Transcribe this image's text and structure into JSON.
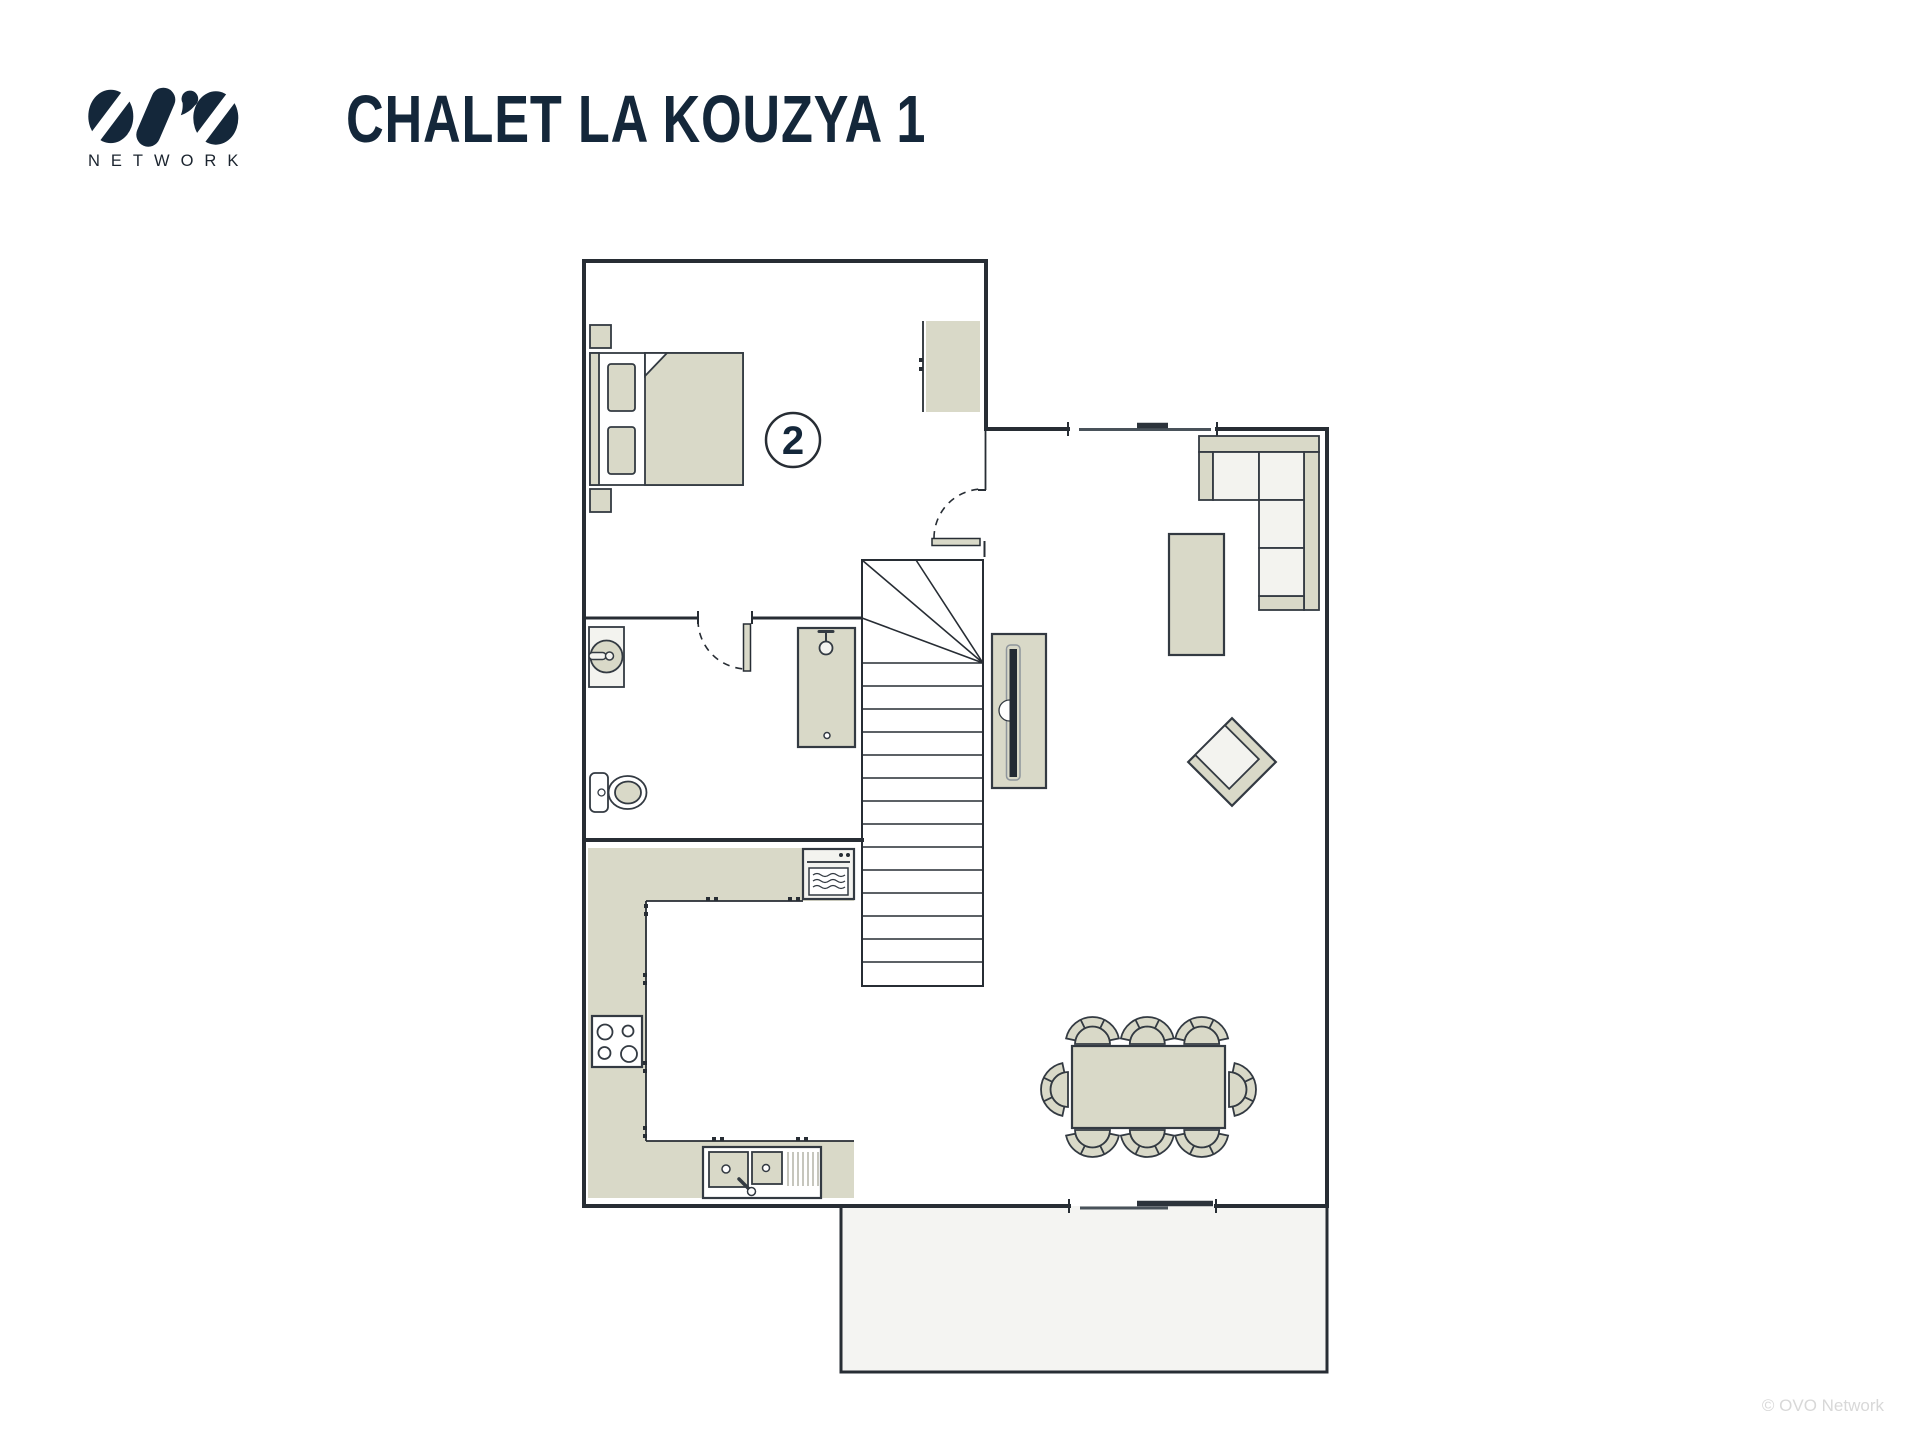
{
  "header": {
    "logo": {
      "icon": "ovo-logo",
      "subtext": "NETWORK"
    },
    "title": "CHALET LA KOUZYA 1"
  },
  "plan": {
    "room_label": "2",
    "furniture": [
      "double-bed",
      "nightstand",
      "wardrobe",
      "bedroom-door",
      "bathroom-door",
      "washbasin",
      "toilet",
      "shower",
      "staircase",
      "kitchen-counter",
      "oven",
      "hob",
      "kitchen-sink",
      "tv-cabinet",
      "tv",
      "corner-sofa",
      "chaise-longue",
      "armchair",
      "dining-table",
      "dining-chair",
      "window",
      "sliding-door",
      "terrace"
    ]
  },
  "footer": {
    "copyright": "© OVO Network"
  },
  "colors": {
    "wall": "#272d34",
    "outline": "#333a42",
    "beige": "#d9d9c8",
    "light": "#f3f3ef",
    "terrace": "#f4f4f2",
    "navy": "#14273a",
    "muted": "#d8d8d8"
  }
}
